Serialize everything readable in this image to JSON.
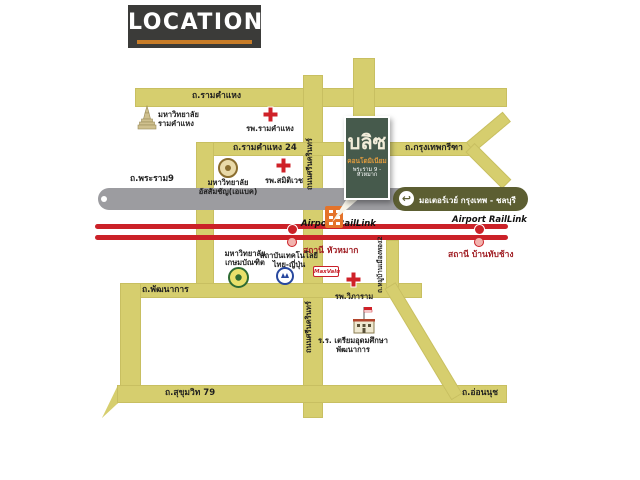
{
  "banner": {
    "title": "LOCATION"
  },
  "logo": {
    "title": "บลิซ",
    "subtitle": "คอนโดมิเนียม",
    "tagline": "พระราม 9 - หัวหมาก"
  },
  "roads": {
    "ramkhamhaeng": "ถ.รามคำแหง",
    "ramkhamhaeng24": "ถ.รามคำแหง 24",
    "krungthep_kreetha": "ถ.กรุงเทพกรีฑา",
    "rama9": "ถ.พระราม9",
    "motorway": "มอเตอร์เวย์ กรุงเทพ - ชลบุรี",
    "srinakarin_top": "ถนนศรีนครินทร์",
    "srinakarin_bottom": "ถนนศรีนครินทร์",
    "pattanakarn": "ถ.พัฒนาการ",
    "sukhumvit79": "ถ.สุขุมวิท 79",
    "onnut": "ถ.อ่อนนุช",
    "muban_mueangthong2": "ถ.หมู่บ้านเมืองทอง2"
  },
  "rail": {
    "huamak": {
      "line_label": "Airport RailLink",
      "station": "สถานี หัวหมาก"
    },
    "banthapchang": {
      "line_label": "Airport RailLink",
      "station": "สถานี บ้านทับช้าง"
    }
  },
  "places": {
    "ramkhamhaeng_university": "มหาวิทยาลัย\nรามคำแหง",
    "ramkhamhaeng_hospital": "รพ.รามคำแหง",
    "abac_university": "มหาวิทยาลัย\nอัสสัมชัญ(เอแบค)",
    "samitivej_hospital": "รพ.สมิติเวช",
    "kasem_bundit_university": "มหาวิทยาลัย\nเกษมบัณฑิต",
    "thai_nichi_institute": "สถาบันเทคโนโลยี\nไทย-ญี่ปุ่น",
    "maxvalu": "MaxValu",
    "vibharam_hospital": "รพ.วิภาราม",
    "triamudom_school": "ร.ร. เตรียมอุดมศึกษา\nพัฒนาการ"
  },
  "icons": {
    "u_turn": "↩"
  },
  "colors": {
    "road_yellow": "#d6ce6e",
    "motorway_gray": "#9c9ca0",
    "motorway_sign": "#5c5e32",
    "rail_red": "#cb2128",
    "logo_green": "#465a4c",
    "accent_orange": "#c77c28"
  }
}
